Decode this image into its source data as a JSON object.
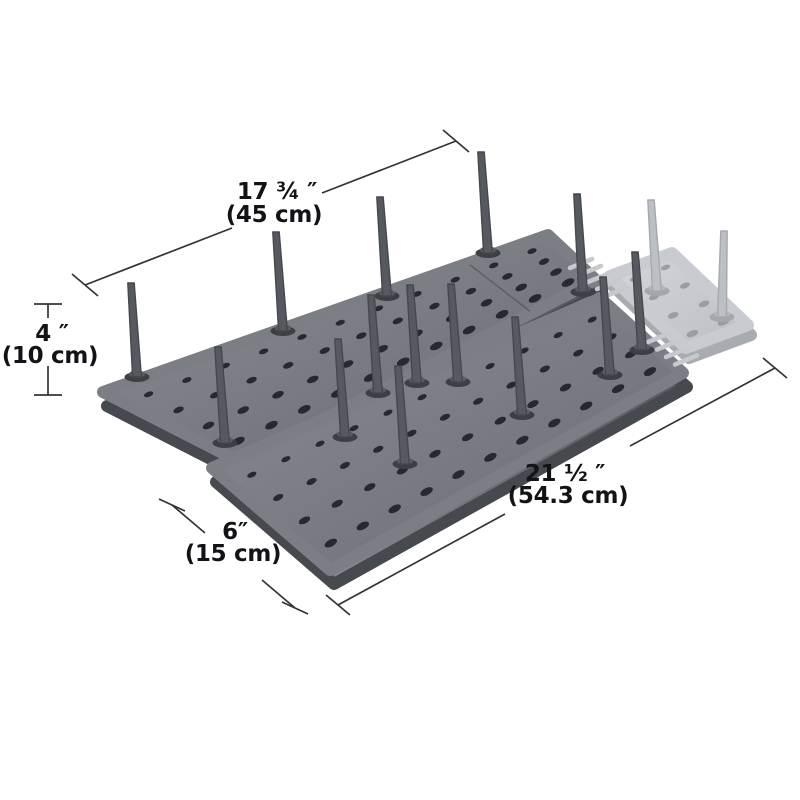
{
  "labels": {
    "width_in": "17 ¾ ″",
    "width_cm": "(45 cm)",
    "height_in": "4 ″",
    "height_cm": "(10 cm)",
    "depth_in": "6″",
    "depth_cm": "(15 cm)",
    "length_in": "21 ½ ″",
    "length_cm": "(54.3 cm)"
  },
  "colors": {
    "background": "#ffffff",
    "dim_line": "#313438",
    "text": "#121316",
    "board_top_light": "#8a8e94",
    "board_top_dark": "#686c72",
    "board_side_dark": "#46494e",
    "board_side_light": "#85888c",
    "hole_dark": "#26292d",
    "peg_dark": "#56595f",
    "peg_ring_dark": "#3c3f44",
    "ghost_top_light": "#d3d6da",
    "ghost_top_dark": "#bcbfc3",
    "ghost_side": "#a8abaf",
    "ghost_hole": "#9a9da2",
    "ghost_peg": "#bcbfc4",
    "ghost_ring": "#a3a6ab",
    "comb": "#c6c9cd",
    "seam": "rgba(35,38,42,0.35)"
  },
  "scene": {
    "boards": [
      {
        "name": "rear-pegboard",
        "style": "dark",
        "quad": [
          [
            103,
            392
          ],
          [
            548,
            235
          ],
          [
            596,
            280
          ],
          [
            240,
            462
          ]
        ],
        "cols": 11,
        "rows": 4,
        "u0": 0.055,
        "u1": 0.945,
        "v0": 0.16,
        "v1": 0.84,
        "hole_r": [
          4.4,
          7.2
        ],
        "seam_u": 0.82
      },
      {
        "name": "front-pegboard",
        "style": "dark",
        "quad": [
          [
            212,
            468
          ],
          [
            600,
            298
          ],
          [
            683,
            373
          ],
          [
            330,
            570
          ]
        ],
        "cols": 11,
        "rows": 4,
        "u0": 0.055,
        "u1": 0.945,
        "v0": 0.16,
        "v1": 0.84,
        "hole_r": [
          4.4,
          7.2
        ]
      },
      {
        "name": "extension-board",
        "style": "ghost",
        "quad": [
          [
            610,
            276
          ],
          [
            672,
            253
          ],
          [
            748,
            325
          ],
          [
            686,
            348
          ]
        ],
        "cols": 2,
        "rows": 4,
        "u0": 0.25,
        "u1": 0.75,
        "v0": 0.12,
        "v1": 0.88,
        "hole_r": [
          4.6,
          6.2
        ]
      }
    ],
    "combs": [
      {
        "start": [
          570,
          268
        ],
        "step": [
          9,
          7
        ],
        "bar": [
          22,
          -9
        ],
        "count": 5
      },
      {
        "start": [
          648,
          342
        ],
        "step": [
          9,
          7.5
        ],
        "bar": [
          22,
          -9
        ],
        "count": 4
      }
    ],
    "pegs": [
      {
        "style": "dark",
        "base": [
          137,
          377
        ],
        "top": [
          131,
          283
        ]
      },
      {
        "style": "dark",
        "base": [
          225,
          443
        ],
        "top": [
          218,
          347
        ]
      },
      {
        "style": "dark",
        "base": [
          283,
          331
        ],
        "top": [
          276,
          232
        ]
      },
      {
        "style": "dark",
        "base": [
          387,
          296
        ],
        "top": [
          380,
          197
        ]
      },
      {
        "style": "dark",
        "base": [
          378,
          393
        ],
        "top": [
          371,
          295
        ]
      },
      {
        "style": "dark",
        "base": [
          488,
          253
        ],
        "top": [
          481,
          152
        ]
      },
      {
        "style": "dark",
        "base": [
          583,
          292
        ],
        "top": [
          577,
          194
        ]
      },
      {
        "style": "dark",
        "base": [
          345,
          437
        ],
        "top": [
          338,
          339
        ]
      },
      {
        "style": "dark",
        "base": [
          405,
          464
        ],
        "top": [
          398,
          366
        ]
      },
      {
        "style": "dark",
        "base": [
          417,
          383
        ],
        "top": [
          410,
          285
        ]
      },
      {
        "style": "dark",
        "base": [
          458,
          382
        ],
        "top": [
          451,
          284
        ]
      },
      {
        "style": "dark",
        "base": [
          522,
          415
        ],
        "top": [
          515,
          317
        ]
      },
      {
        "style": "dark",
        "base": [
          610,
          375
        ],
        "top": [
          603,
          277
        ]
      },
      {
        "style": "dark",
        "base": [
          642,
          350
        ],
        "top": [
          635,
          252
        ]
      },
      {
        "style": "ghost",
        "base": [
          657,
          291
        ],
        "top": [
          651,
          200
        ]
      },
      {
        "style": "ghost",
        "base": [
          722,
          317
        ],
        "top": [
          724,
          231
        ]
      }
    ],
    "dim_lines": [
      {
        "name": "width-dimension",
        "segments": [
          [
            [
              85,
              285
            ],
            [
              232,
              228
            ]
          ],
          [
            [
              322,
              193
            ],
            [
              456,
              141
            ]
          ]
        ],
        "ticks": [
          {
            "c": [
              85,
              285
            ],
            "d": [
              13,
              11
            ]
          },
          {
            "c": [
              456,
              141
            ],
            "d": [
              13,
              11
            ]
          }
        ]
      },
      {
        "name": "height-dimension",
        "segments": [
          [
            [
              48,
              304
            ],
            [
              48,
              318
            ]
          ],
          [
            [
              48,
              366
            ],
            [
              48,
              395
            ]
          ]
        ],
        "ticks": [
          {
            "c": [
              48,
              304
            ],
            "d": [
              14,
              0
            ]
          },
          {
            "c": [
              48,
              395
            ],
            "d": [
              14,
              0
            ]
          }
        ]
      },
      {
        "name": "depth-dimension",
        "segments": [
          [
            [
              172,
              505
            ],
            [
              205,
              533
            ]
          ],
          [
            [
              262,
              580
            ],
            [
              295,
              608
            ]
          ]
        ],
        "ticks": [
          {
            "c": [
              172,
              505
            ],
            "d": [
              13,
              6
            ]
          },
          {
            "c": [
              295,
              608
            ],
            "d": [
              13,
              6
            ]
          }
        ]
      },
      {
        "name": "length-dimension",
        "segments": [
          [
            [
              338,
              605
            ],
            [
              505,
              514
            ]
          ],
          [
            [
              630,
              446
            ],
            [
              775,
              368
            ]
          ]
        ],
        "ticks": [
          {
            "c": [
              338,
              605
            ],
            "d": [
              12,
              10
            ]
          },
          {
            "c": [
              775,
              368
            ],
            "d": [
              12,
              10
            ]
          }
        ]
      }
    ],
    "label_pos": {
      "width_in": [
        277,
        199
      ],
      "width_cm": [
        274,
        222
      ],
      "height_in": [
        52,
        341
      ],
      "height_cm": [
        50,
        363
      ],
      "depth_in": [
        235,
        539
      ],
      "depth_cm": [
        233,
        561
      ],
      "length_in": [
        565,
        481
      ],
      "length_cm": [
        568,
        503
      ]
    }
  }
}
